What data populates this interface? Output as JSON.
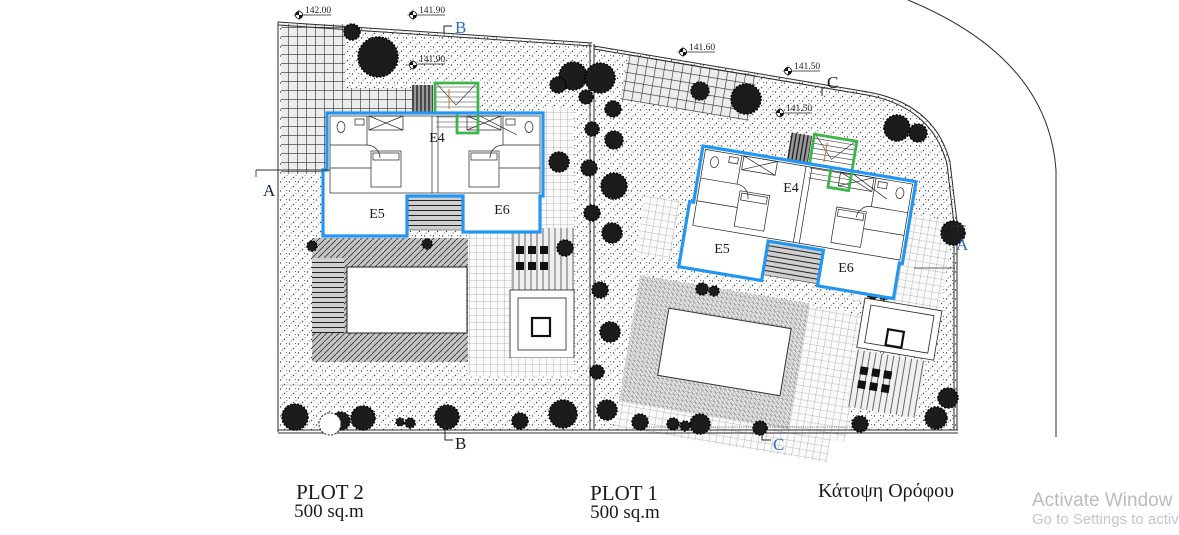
{
  "title": {
    "floor_plan": "Κάτοψη Ορόφου"
  },
  "plots": [
    {
      "name": "PLOT 2",
      "area": "500 sq.m"
    },
    {
      "name": "PLOT 1",
      "area": "500 sq.m"
    }
  ],
  "levels": {
    "top_left": "142.00",
    "top_mid": "141.90",
    "mid_left": "141.90",
    "top_right": "141.60",
    "right_upper": "141.50",
    "right_mid": "141.50"
  },
  "sections": {
    "a": "A",
    "b": "B",
    "c": "C"
  },
  "units": {
    "e4": "E4",
    "e5": "E5",
    "e6": "E6"
  },
  "watermark": {
    "line1": "Activate Window",
    "line2": "Go to Settings to activ"
  },
  "colors": {
    "unit_outline": "#2196f3",
    "stair_outline": "#3cb54a",
    "ink": "#1a1a1a",
    "watermark_gray": "#b9bcc1"
  }
}
